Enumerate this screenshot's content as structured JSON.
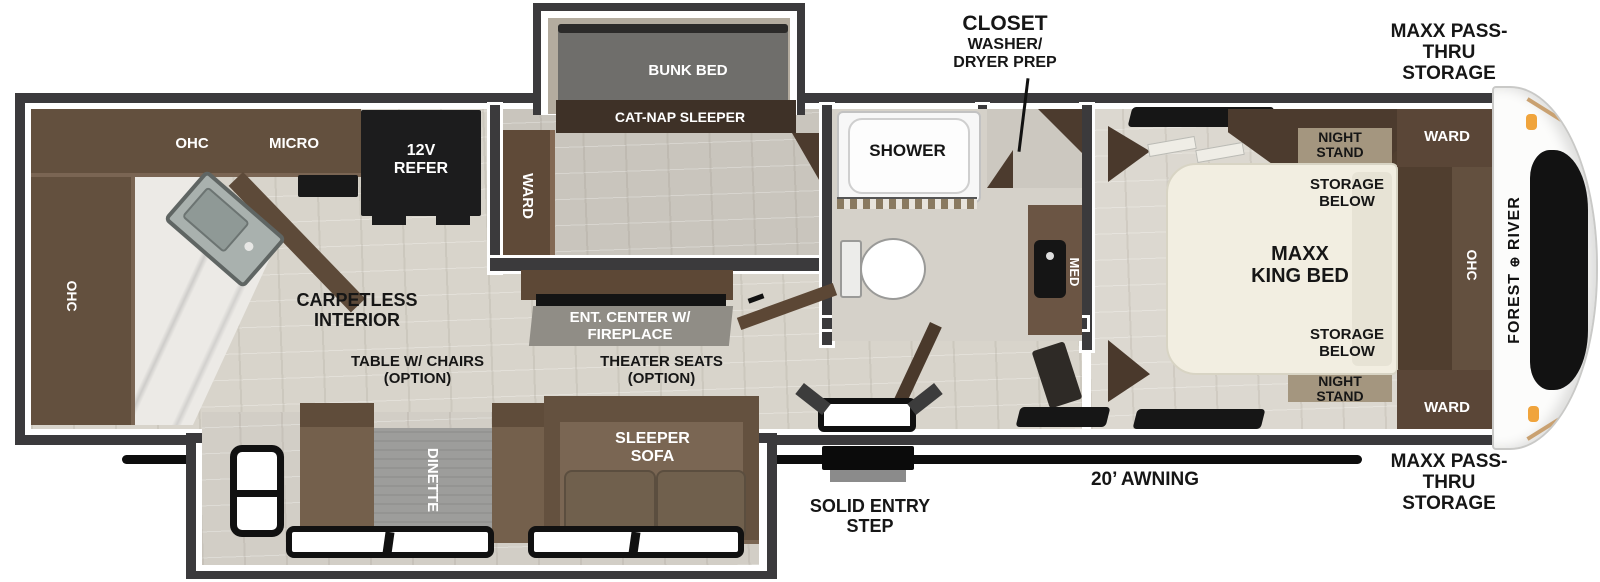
{
  "brand": {
    "name_first": "FOREST",
    "logo_glyph": "⊕",
    "name_second": "RIVER"
  },
  "colors": {
    "wall": "#3b3a3c",
    "floor": "#d8d4cb",
    "cabinet_brown": "#63503e",
    "dark_wood": "#4c3b2e",
    "appliance_black": "#1c1c1d",
    "bed_cream": "#f2eee1",
    "sofa_brown": "#7a6653",
    "awning_black": "#0d0d0d",
    "marker_amber": "#f0a43c",
    "stripe_tan": "#c9a171"
  },
  "exterior_labels": {
    "closet_title": "CLOSET",
    "closet_sub": "WASHER/ DRYER PREP",
    "passthru_top": "MAXX PASS-THRU STORAGE",
    "passthru_bottom": "MAXX PASS-THRU STORAGE",
    "awning": "20’ AWNING",
    "entry_step": "SOLID ENTRY STEP"
  },
  "kitchen": {
    "ohc_top": "OHC",
    "micro": "MICRO",
    "refer": "12V REFER",
    "ohc_side": "OHC"
  },
  "bunk_room": {
    "bunk_bed": "BUNK BED",
    "cat_nap": "CAT-NAP SLEEPER",
    "ward": "WARD"
  },
  "living": {
    "carpetless": "CARPETLESS INTERIOR",
    "ent_center": "ENT. CENTER W/ FIREPLACE",
    "table_option": "TABLE W/ CHAIRS (OPTION)",
    "theater_option": "THEATER SEATS (OPTION)",
    "dinette": "DINETTE",
    "sleeper_sofa": "SLEEPER SOFA"
  },
  "bath": {
    "shower": "SHOWER",
    "med": "MED"
  },
  "bedroom": {
    "night_stand_top": "NIGHT STAND",
    "storage_top": "STORAGE BELOW",
    "king_bed": "MAXX KING BED",
    "storage_bottom": "STORAGE BELOW",
    "night_stand_bottom": "NIGHT STAND",
    "ward_top": "WARD",
    "ward_bottom": "WARD",
    "ohc": "OHC"
  }
}
